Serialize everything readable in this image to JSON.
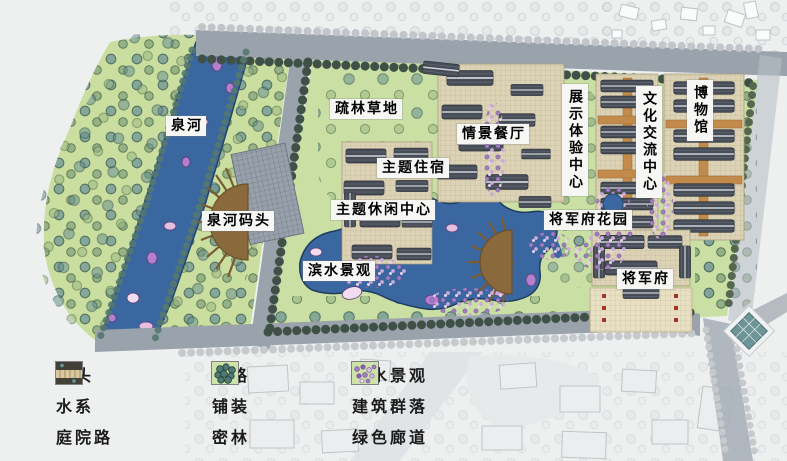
{
  "labels": [
    {
      "id": "quanhe-river",
      "text": "泉河"
    },
    {
      "id": "quanhe-wharf",
      "text": "泉河码头"
    },
    {
      "id": "sparse-forest-meadow",
      "text": "疏林草地"
    },
    {
      "id": "scene-restaurant",
      "text": "情景餐厅"
    },
    {
      "id": "theme-lodging",
      "text": "主题住宿"
    },
    {
      "id": "theme-leisure-center",
      "text": "主题休闲中心"
    },
    {
      "id": "waterfront-landscape",
      "text": "滨水景观"
    },
    {
      "id": "exhibition-experience-center",
      "text": "展示体验中心"
    },
    {
      "id": "cultural-exchange-center",
      "text": "文化交流中心"
    },
    {
      "id": "museum",
      "text": "博物馆"
    },
    {
      "id": "general-mansion-garden",
      "text": "将军府花园"
    },
    {
      "id": "general-mansion",
      "text": "将军府"
    }
  ],
  "legend": {
    "items": [
      {
        "label": "码头",
        "icon": "wharf-icon"
      },
      {
        "label": "水系",
        "icon": "water-system-icon"
      },
      {
        "label": "庭院路",
        "icon": "courtyard-road-icon"
      },
      {
        "label": "道路",
        "icon": "road-icon"
      },
      {
        "label": "铺装",
        "icon": "paving-icon"
      },
      {
        "label": "密林",
        "icon": "dense-forest-icon"
      },
      {
        "label": "滨水景观",
        "icon": "waterfront-icon"
      },
      {
        "label": "建筑群落",
        "icon": "building-cluster-icon"
      },
      {
        "label": "绿色廊道",
        "icon": "green-corridor-icon"
      }
    ]
  },
  "colors": {
    "water": "#3a679f",
    "park_green": "#cade9f",
    "road_gray": "#9aa2ab",
    "roof_gray": "#474d57",
    "paving_cream": "#e7dfc2",
    "lotus_pink": "#e5bfe0",
    "shrub_purple": "#a27fc3",
    "tree_teal": "#6e9596",
    "path_orange": "#c28a4b"
  }
}
